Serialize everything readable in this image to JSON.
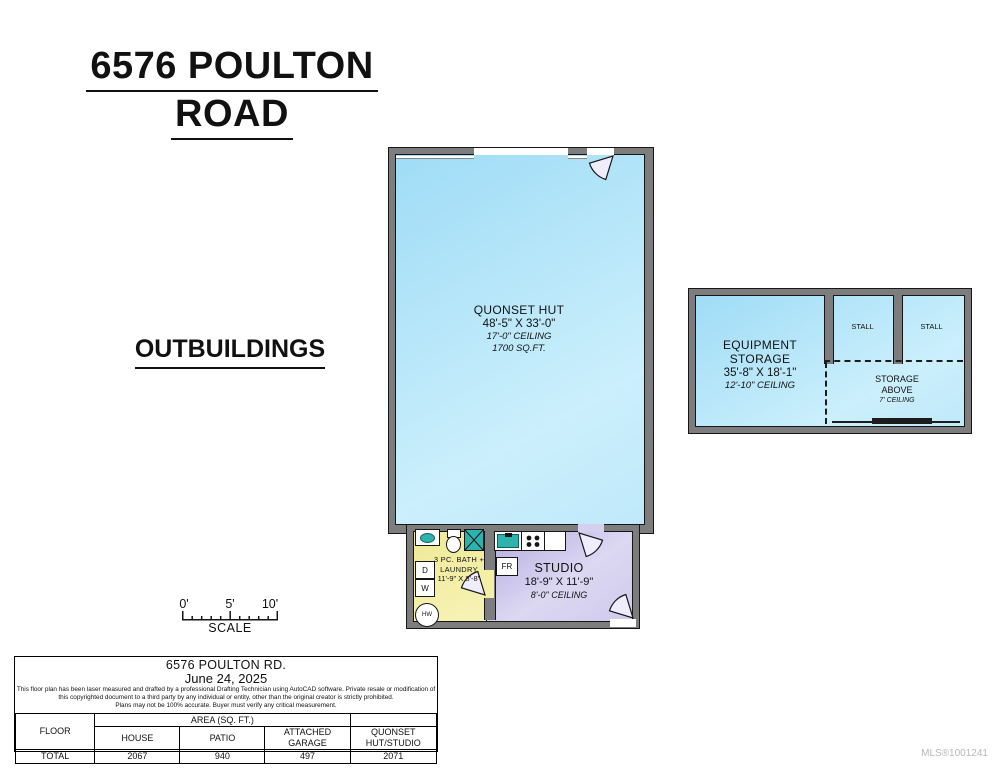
{
  "page": {
    "title_line1": "6576 POULTON",
    "title_line2": "ROAD",
    "section_label": "OUTBUILDINGS",
    "mls_number": "MLS®1001241"
  },
  "quonset": {
    "name": "QUONSET HUT",
    "dimensions": "48'-5\" X 33'-0\"",
    "ceiling": "17'-0\" CEILING",
    "area": "1700 SQ.FT."
  },
  "bath": {
    "label_line1": "3 PC. BATH +",
    "label_line2": "LAUNDRY",
    "dimensions": "11'-9\" X 8'-8\"",
    "dryer_label": "D",
    "washer_label": "W",
    "water_heater_label": "HW"
  },
  "studio": {
    "name": "STUDIO",
    "dimensions": "18'-9\" X 11'-9\"",
    "ceiling": "8'-0\" CEILING",
    "fridge_label": "FR"
  },
  "equipment_storage": {
    "name": "EQUIPMENT STORAGE",
    "dimensions": "35'-8\" X 18'-1\"",
    "ceiling": "12'-10\" CEILING",
    "stalls": [
      "STALL",
      "STALL"
    ],
    "storage_above_line1": "STORAGE",
    "storage_above_line2": "ABOVE",
    "storage_above_ceiling": "7' CEILING"
  },
  "scale_bar": {
    "tick_labels": [
      "0'",
      "5'",
      "10'"
    ],
    "label": "SCALE"
  },
  "info_box": {
    "address": "6576 POULTON RD.",
    "date": "June 24, 2025",
    "disclaimer": [
      "This floor plan has been laser measured and drafted by a professional Drafting Technician using AutoCAD software. Private resale or modification of",
      "this copyrighted document to a third party by any individual or entity, other than the original creator is strictly prohibited.",
      "Plans may not be 100% accurate.  Buyer must verify any critical measurement."
    ],
    "table": {
      "floor_header": "FLOOR",
      "area_header": "AREA (SQ. FT.)",
      "col_headers": [
        "HOUSE",
        "PATIO",
        "ATTACHED GARAGE",
        "QUONSET HUT/STUDIO"
      ],
      "row_label": "TOTAL",
      "values": [
        "2067",
        "940",
        "497",
        "2071"
      ]
    }
  },
  "colors": {
    "wall": "#7d7d7d",
    "outline": "#161616",
    "room-blue-1": "#9fdcf6",
    "room-blue-2": "#cbeffc",
    "room-yellow-1": "#efe996",
    "room-yellow-2": "#f7f3b6",
    "room-purple-1": "#b2aadf",
    "room-purple-2": "#dcd8f2",
    "fixture-teal": "#2cb3ae",
    "door-fill": "#efedfb"
  }
}
